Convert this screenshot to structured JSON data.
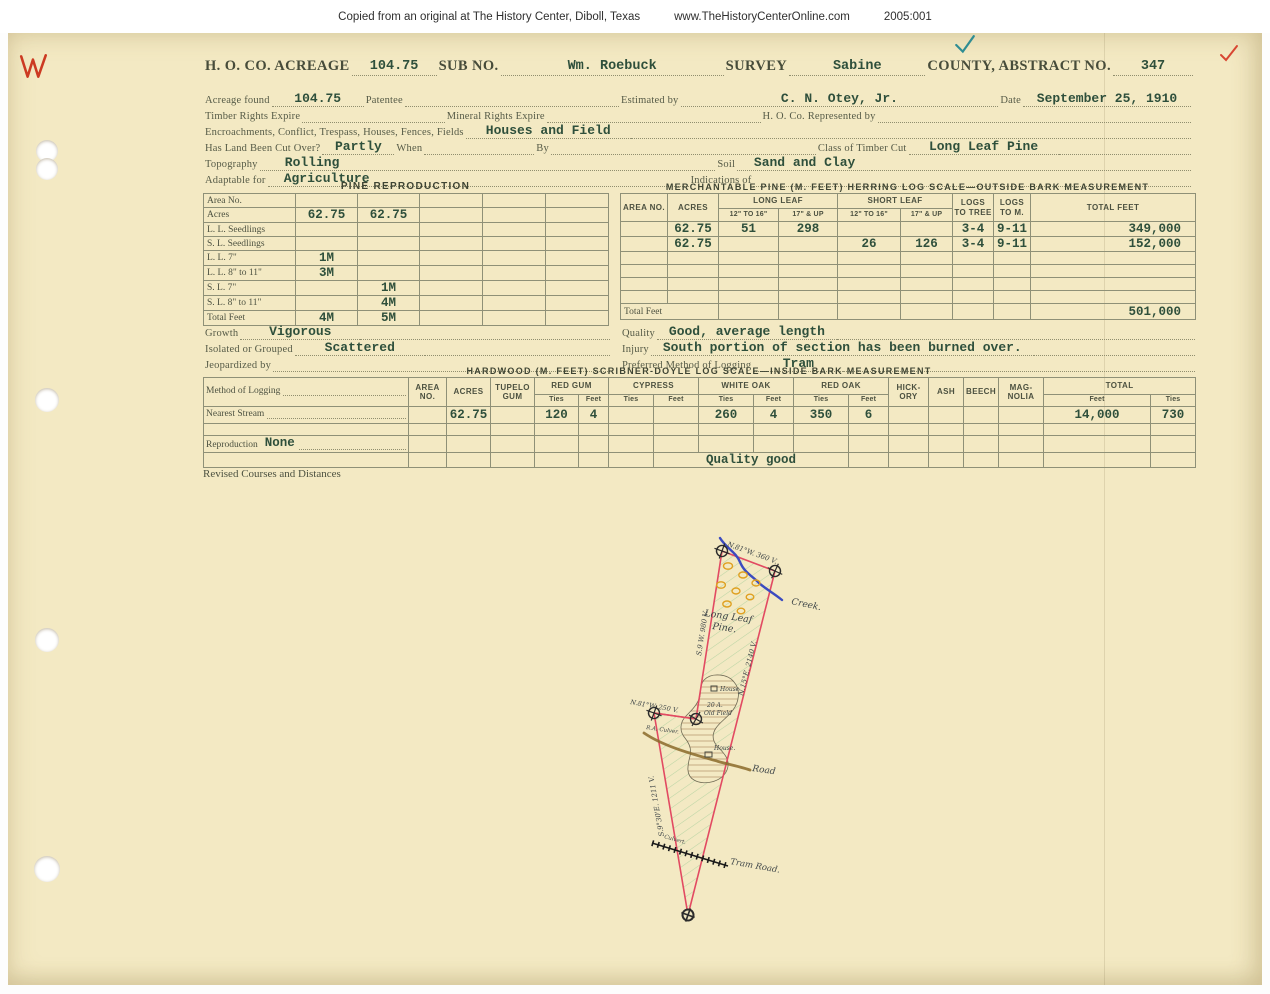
{
  "scan_strip": {
    "text": "Copied from an original at The History Center, Diboll, Texas",
    "site": "www.TheHistoryCenterOnline.com",
    "accession": "2005:001"
  },
  "header": {
    "co_label": "H. O. CO. ACREAGE",
    "acreage": "104.75",
    "sub_no_label": "SUB NO.",
    "survey_name": "Wm. Roebuck",
    "survey_label": "SURVEY",
    "county": "Sabine",
    "county_label": "COUNTY, ABSTRACT NO.",
    "abstract_no": "347"
  },
  "fields": {
    "acreage_found_label": "Acreage found",
    "acreage_found": "104.75",
    "patentee_label": "Patentee",
    "estimated_by_label": "Estimated by",
    "estimated_by": "C. N. Otey, Jr.",
    "date_label": "Date",
    "date": "September 25, 1910",
    "timber_rights_label": "Timber Rights Expire",
    "mineral_rights_label": "Mineral Rights Expire",
    "represented_by_label": "H. O. Co. Represented by",
    "encroachments_label": "Encroachments, Conflict, Trespass, Houses, Fences, Fields",
    "encroachments": "Houses and Field",
    "cut_over_label": "Has Land Been Cut Over?",
    "cut_over": "Partly",
    "when_label": "When",
    "by_label": "By",
    "timber_class_label": "Class of Timber Cut",
    "timber_class": "Long Leaf Pine",
    "topography_label": "Topography",
    "topography": "Rolling",
    "soil_label": "Soil",
    "soil": "Sand and Clay",
    "adaptable_label": "Adaptable for",
    "adaptable": "Agriculture",
    "indications_label": "Indications of",
    "growth_label": "Growth",
    "growth": "Vigorous",
    "isolated_label": "Isolated or Grouped",
    "isolated": "Scattered",
    "jeopardized_label": "Jeopardized by",
    "quality_label": "Quality",
    "quality": "Good, average length",
    "injury_label": "Injury",
    "injury": "South portion of section has been burned over.",
    "logging_method_label": "Preferred Method of Logging",
    "logging_method": "Tram",
    "revised_label": "Revised Courses and Distances"
  },
  "pine_reproduction": {
    "title": "PINE REPRODUCTION",
    "row_labels": [
      "Area No.",
      "Acres",
      "L. L. Seedlings",
      "S. L. Seedlings",
      "L. L. 7\"",
      "L. L. 8\" to 11\"",
      "S. L. 7\"",
      "S. L. 8\" to 11\"",
      "Total Feet"
    ],
    "values": {
      "acres_1": "62.75",
      "acres_2": "62.75",
      "ll7_1": "1M",
      "ll811_1": "3M",
      "sl7_2": "1M",
      "sl811_2": "4M",
      "total_1": "4M",
      "total_2": "5M"
    }
  },
  "merchantable_pine": {
    "title": "MERCHANTABLE PINE (M. FEET) HERRING LOG SCALE—OUTSIDE BARK MEASUREMENT",
    "headers": {
      "area": "AREA NO.",
      "acres": "ACRES",
      "long_leaf": "LONG LEAF",
      "short_leaf": "SHORT LEAF",
      "sub_small": "12\" TO 16\"",
      "sub_large": "17\" & UP",
      "logs_to_tree": "LOGS TO TREE",
      "logs_to_m": "LOGS TO M.",
      "total_feet": "TOTAL FEET"
    },
    "rows": [
      {
        "acres": "62.75",
        "ll_small": "51",
        "ll_large": "298",
        "sl_small": "",
        "sl_large": "",
        "logs_tree": "3-4",
        "logs_m": "9-11",
        "total": "349,000"
      },
      {
        "acres": "62.75",
        "ll_small": "",
        "ll_large": "",
        "sl_small": "26",
        "sl_large": "126",
        "logs_tree": "3-4",
        "logs_m": "9-11",
        "total": "152,000"
      }
    ],
    "total_label": "Total Feet",
    "total": "501,000"
  },
  "hardwood": {
    "title": "HARDWOOD (M. FEET) SCRIBNER-DOYLE LOG SCALE—INSIDE BARK MEASUREMENT",
    "headers": {
      "method": "Method of Logging",
      "area": "AREA NO.",
      "acres": "ACRES",
      "tupelo": "TUPELO GUM",
      "red_gum": "RED GUM",
      "cypress": "CYPRESS",
      "white_oak": "WHITE OAK",
      "red_oak": "RED OAK",
      "hickory": "HICK-ORY",
      "ash": "ASH",
      "beech": "BEECH",
      "magnolia": "MAG-NOLIA",
      "total": "TOTAL",
      "ties": "Ties",
      "feet": "Feet"
    },
    "nearest_stream_label": "Nearest Stream",
    "reproduction_label": "Reproduction",
    "reproduction": "None",
    "stream_row": {
      "acres": "62.75",
      "red_gum_ties": "120",
      "red_gum_feet": "4",
      "white_oak_ties": "260",
      "white_oak_feet": "4",
      "red_oak_ties": "350",
      "red_oak_feet": "6",
      "total_feet": "14,000",
      "total_ties": "730"
    },
    "quality_note": "Quality good"
  },
  "map": {
    "bearing_top": "N.81°W. 360 V.",
    "bearing_upper_left": "S.9 W. 980 V.",
    "bearing_right": "N.15°E. 2140 V.",
    "bearing_jog": "N.81°W. 250 V.",
    "bearing_lower_left": "S.9°30'E. 1211 V.",
    "area_line1": "Long Leaf",
    "area_line2": "Pine.",
    "creek_label": "Creek.",
    "road_label": "Road",
    "tram_label": "Tram Road.",
    "culvert_label": "Culvert.",
    "owner_label": "R.A. Culver.",
    "house_top_label": "House",
    "old_field_line1": "20 A.",
    "old_field_line2": "Old Field",
    "house_bottom_label": "House."
  },
  "colors": {
    "paper": "#f3e9c3",
    "ink_typed": "#2e4f3b",
    "ink_printed": "#565b47",
    "map_boundary": "#e24a62",
    "map_hatch": "#8cc48c",
    "creek": "#3b4bc0",
    "road": "#8a6a2a",
    "trees": "#dfa020"
  }
}
